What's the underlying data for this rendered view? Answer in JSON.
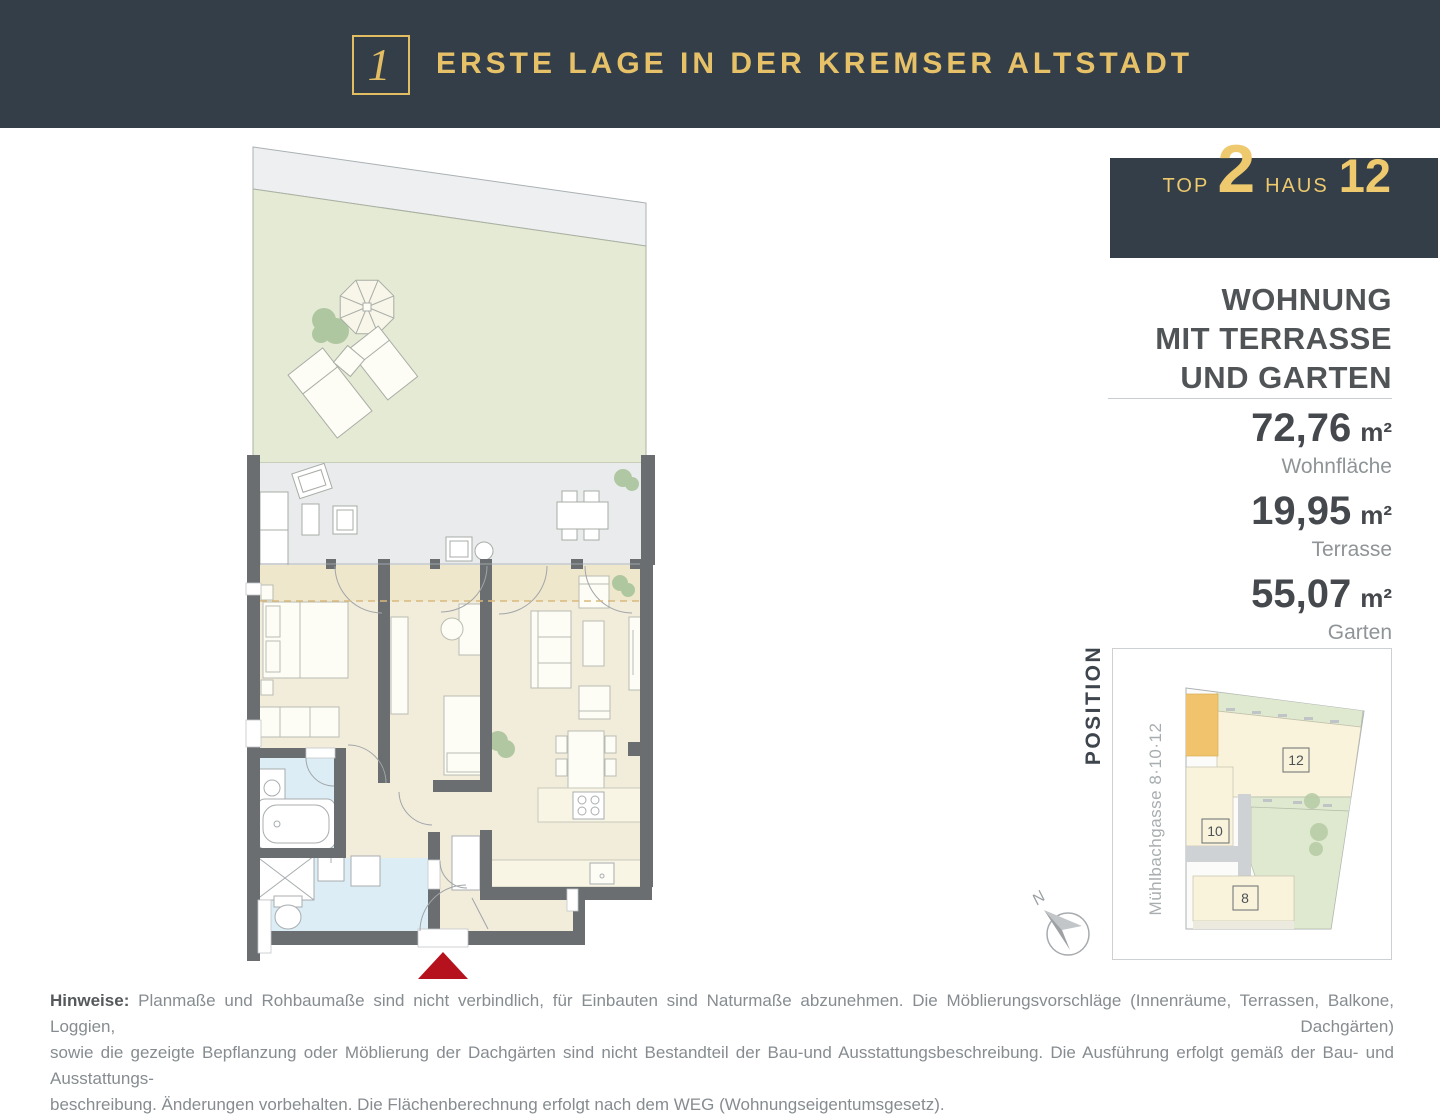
{
  "header": {
    "logo_glyph": "1",
    "title": "ERSTE LAGE IN DER KREMSER ALTSTADT"
  },
  "unit": {
    "top_label": "TOP",
    "top_number": "2",
    "haus_label": "HAUS",
    "haus_number": "12",
    "headline_lines": [
      "WOHNUNG",
      "MIT TERRASSE",
      "UND GARTEN"
    ],
    "areas": [
      {
        "value": "72,76",
        "unit": "m²",
        "label": "Wohnfläche"
      },
      {
        "value": "19,95",
        "unit": "m²",
        "label": "Terrasse"
      },
      {
        "value": "55,07",
        "unit": "m²",
        "label": "Garten"
      }
    ]
  },
  "position": {
    "label": "POSITION",
    "street": "Mühlbachgasse 8·10·12",
    "buildings": [
      "12",
      "10",
      "8"
    ],
    "compass_n": "N"
  },
  "notes": {
    "bold": "Hinweise:",
    "line1": "Planmaße und Rohbaumaße sind nicht verbindlich, für Einbauten sind Naturmaße abzunehmen. Die Möblierungsvorschläge (Innenräume, Terrassen, Balkone, Loggien, Dachgärten)",
    "line2": "sowie die gezeigte Bepflanzung oder Möblierung der Dachgärten sind nicht Bestandteil der Bau-und Ausstattungsbeschreibung. Die Ausführung erfolgt gemäß der Bau- und Ausstattungs-",
    "line3": "beschreibung. Änderungen vorbehalten. Die Flächenberechnung erfolgt nach dem WEG (Wohnungseigentumsgesetz)."
  },
  "colors": {
    "header_bg": "#333e49",
    "gold": "#e6c167",
    "wall": "#6a6e71",
    "garden_green": "#e5ead4",
    "terrace_gray": "#e9ebec",
    "floor_beige": "#f2ecdb",
    "band_beige": "#efe7cb",
    "bath_blue": "#dcedf5",
    "entrance_marker": "#b5121d",
    "site_highlight_orange": "#f1c36c"
  }
}
